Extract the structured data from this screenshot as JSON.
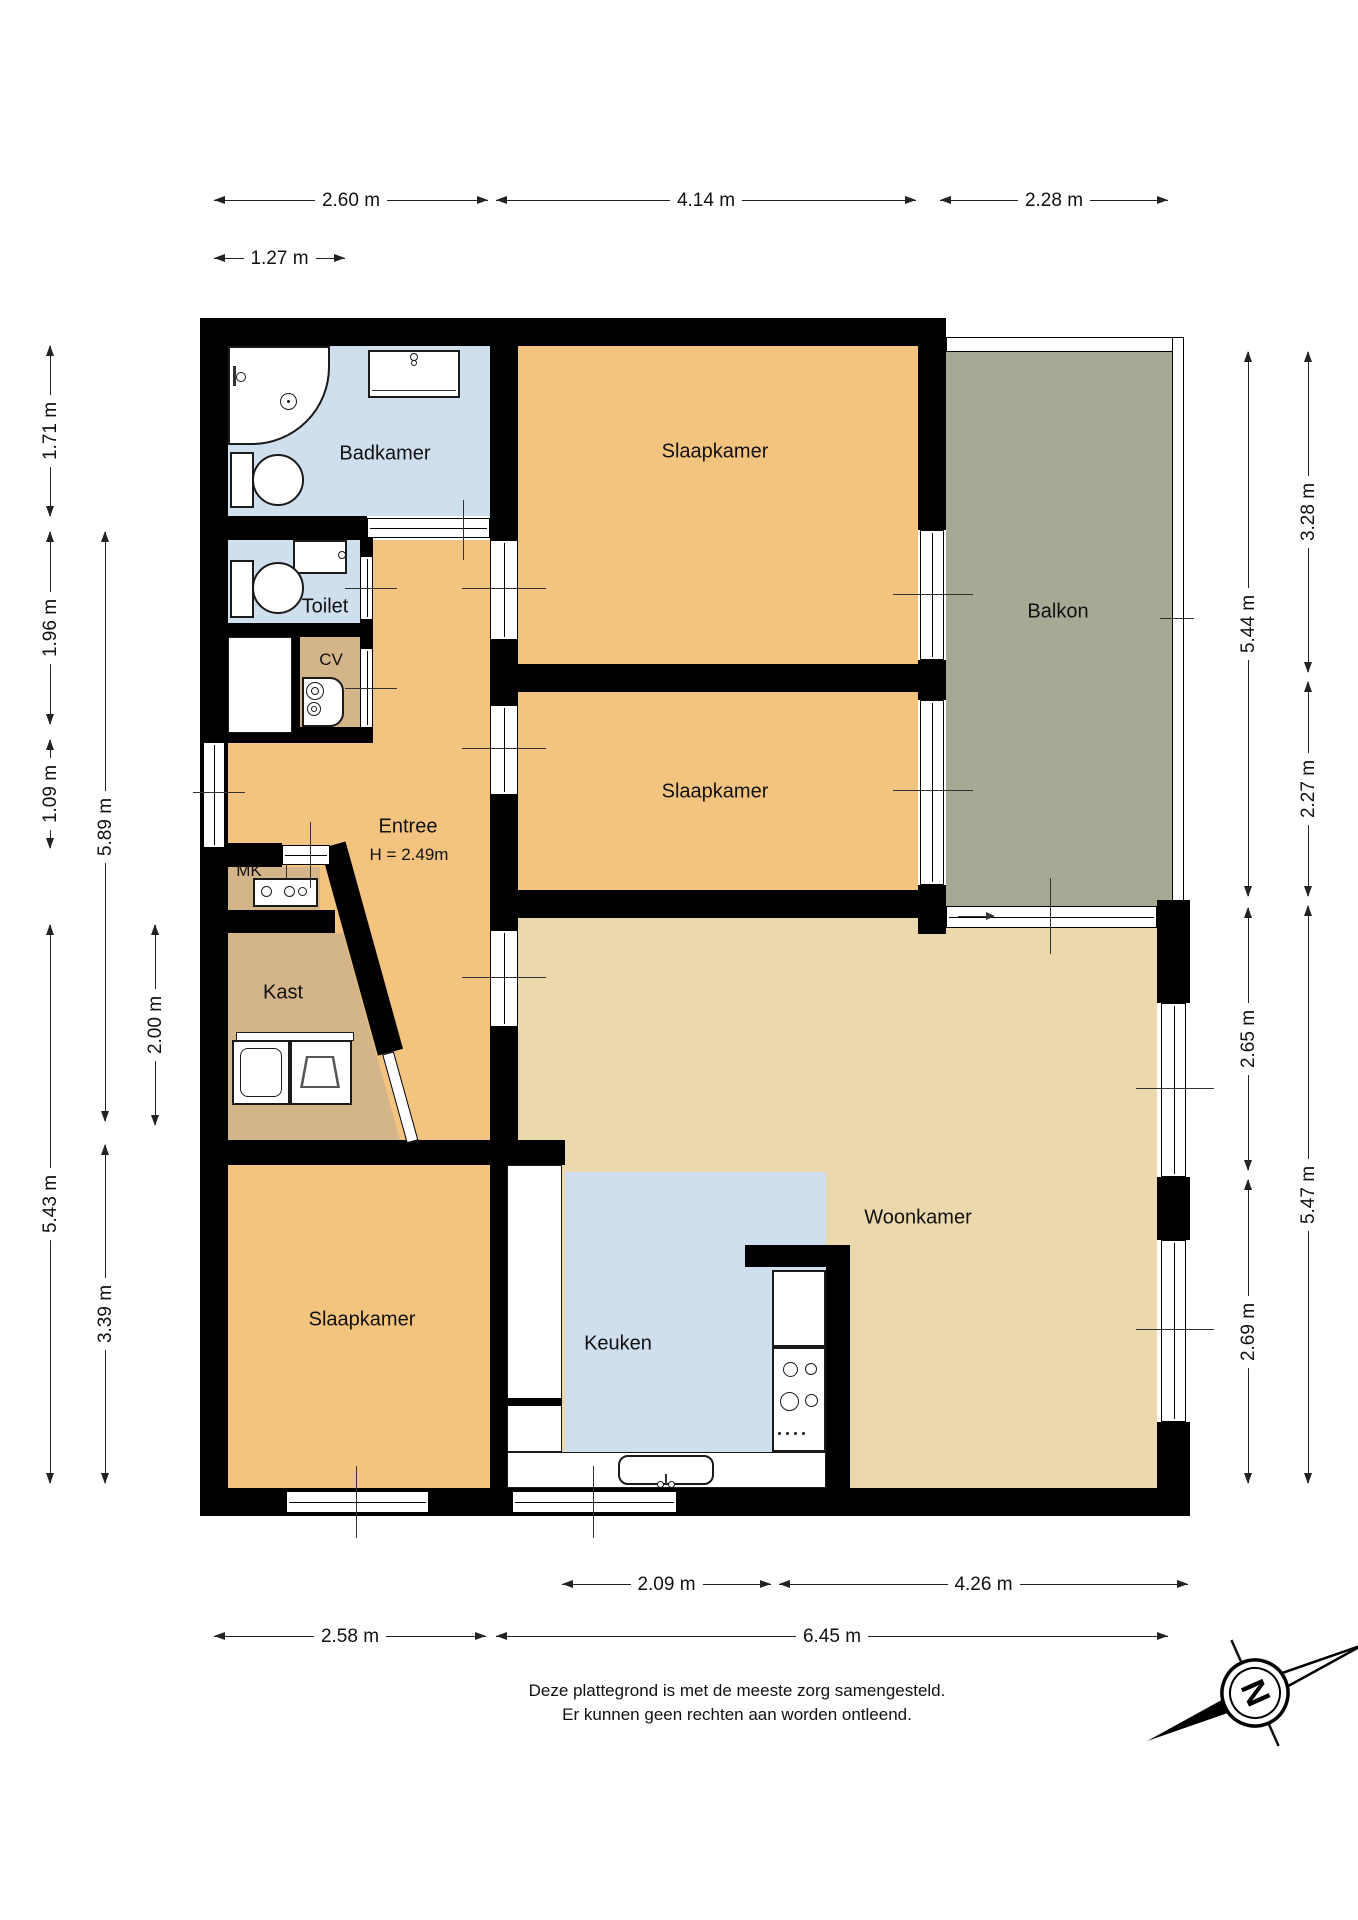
{
  "rooms": {
    "badkamer": {
      "label": "Badkamer"
    },
    "toilet": {
      "label": "Toilet"
    },
    "cv": {
      "label": "CV"
    },
    "mk": {
      "label": "MK"
    },
    "entree": {
      "label": "Entree",
      "height_note": "H = 2.49m"
    },
    "kast": {
      "label": "Kast"
    },
    "slaapkamer_1": {
      "label": "Slaapkamer"
    },
    "slaapkamer_2": {
      "label": "Slaapkamer"
    },
    "slaapkamer_3": {
      "label": "Slaapkamer"
    },
    "keuken": {
      "label": "Keuken"
    },
    "woonkamer": {
      "label": "Woonkamer"
    },
    "balkon": {
      "label": "Balkon"
    }
  },
  "dimensions": {
    "top": [
      "2.60 m",
      "4.14 m",
      "2.28 m",
      "1.27 m"
    ],
    "left": [
      "1.71 m",
      "1.96 m",
      "1.09 m",
      "5.89 m",
      "2.00 m",
      "5.43 m",
      "3.39 m"
    ],
    "right": [
      "3.28 m",
      "5.44 m",
      "2.27 m",
      "2.65 m",
      "5.47 m",
      "2.69 m"
    ],
    "bottom": [
      "2.09 m",
      "4.26 m",
      "2.58 m",
      "6.45 m"
    ]
  },
  "compass": {
    "north_letter": "N"
  },
  "footer": {
    "line1": "Deze plattegrond is met de meeste zorg samengesteld.",
    "line2": "Er kunnen geen rechten aan worden ontleend."
  },
  "colors": {
    "room_orange": "#f3c480",
    "living_beige": "#ebd8ad",
    "wet_room_blue": "#cfdfee",
    "closet_tan": "#d4b489",
    "balcony_olive": "#a7a995",
    "wall_black": "#000000"
  }
}
